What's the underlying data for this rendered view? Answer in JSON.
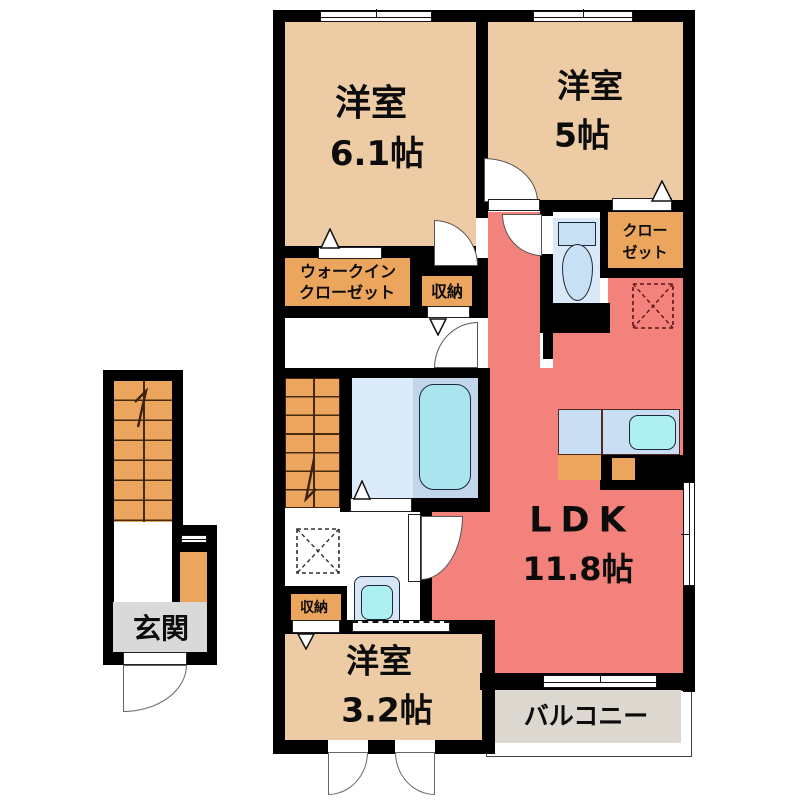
{
  "plan_title": "2F apartment floor plan",
  "rooms": {
    "bedroom1": {
      "name": "洋室",
      "size": "6.1帖"
    },
    "bedroom2": {
      "name": "洋室",
      "size": "5帖"
    },
    "ldk": {
      "name": "LDK",
      "size": "11.8帖"
    },
    "bedroom3": {
      "name": "洋室",
      "size": "3.2帖"
    },
    "wic": {
      "line1": "ウォークイン",
      "line2": "クローゼット"
    },
    "closet": {
      "line1": "クロー",
      "line2": "ゼット"
    },
    "storage_upper": {
      "name": "収納"
    },
    "storage_lower": {
      "name": "収納"
    },
    "entrance": {
      "name": "玄関"
    },
    "balcony": {
      "name": "バルコニー"
    }
  },
  "fixtures": {
    "toilet": "toilet",
    "bathtub": "bathtub",
    "washbasin": "washbasin",
    "kitchen_sink": "kitchen-sink",
    "washing_machine_space": "washing-machine-space-dashed",
    "refrigerator_space": "refrigerator-space-dashed",
    "stairs_internal": "staircase-up",
    "stairs_entry": "staircase-entry"
  },
  "colors": {
    "wall": "#000000",
    "bedroom": "#EDCBA4",
    "ldk": "#F4827C",
    "storage": "#EBA55C",
    "toilet_room": "#D9E9F7",
    "bath_room": "#DCEBF9",
    "tub_deck": "#C2D5EB",
    "tub": "#A9E4EF",
    "counter": "#C9DEF3",
    "sink": "#AEF0F2",
    "fixture_blue": "#C8E0F4",
    "entrance_gray": "#D9D9D9",
    "balcony_gray": "#DCD8D0"
  }
}
